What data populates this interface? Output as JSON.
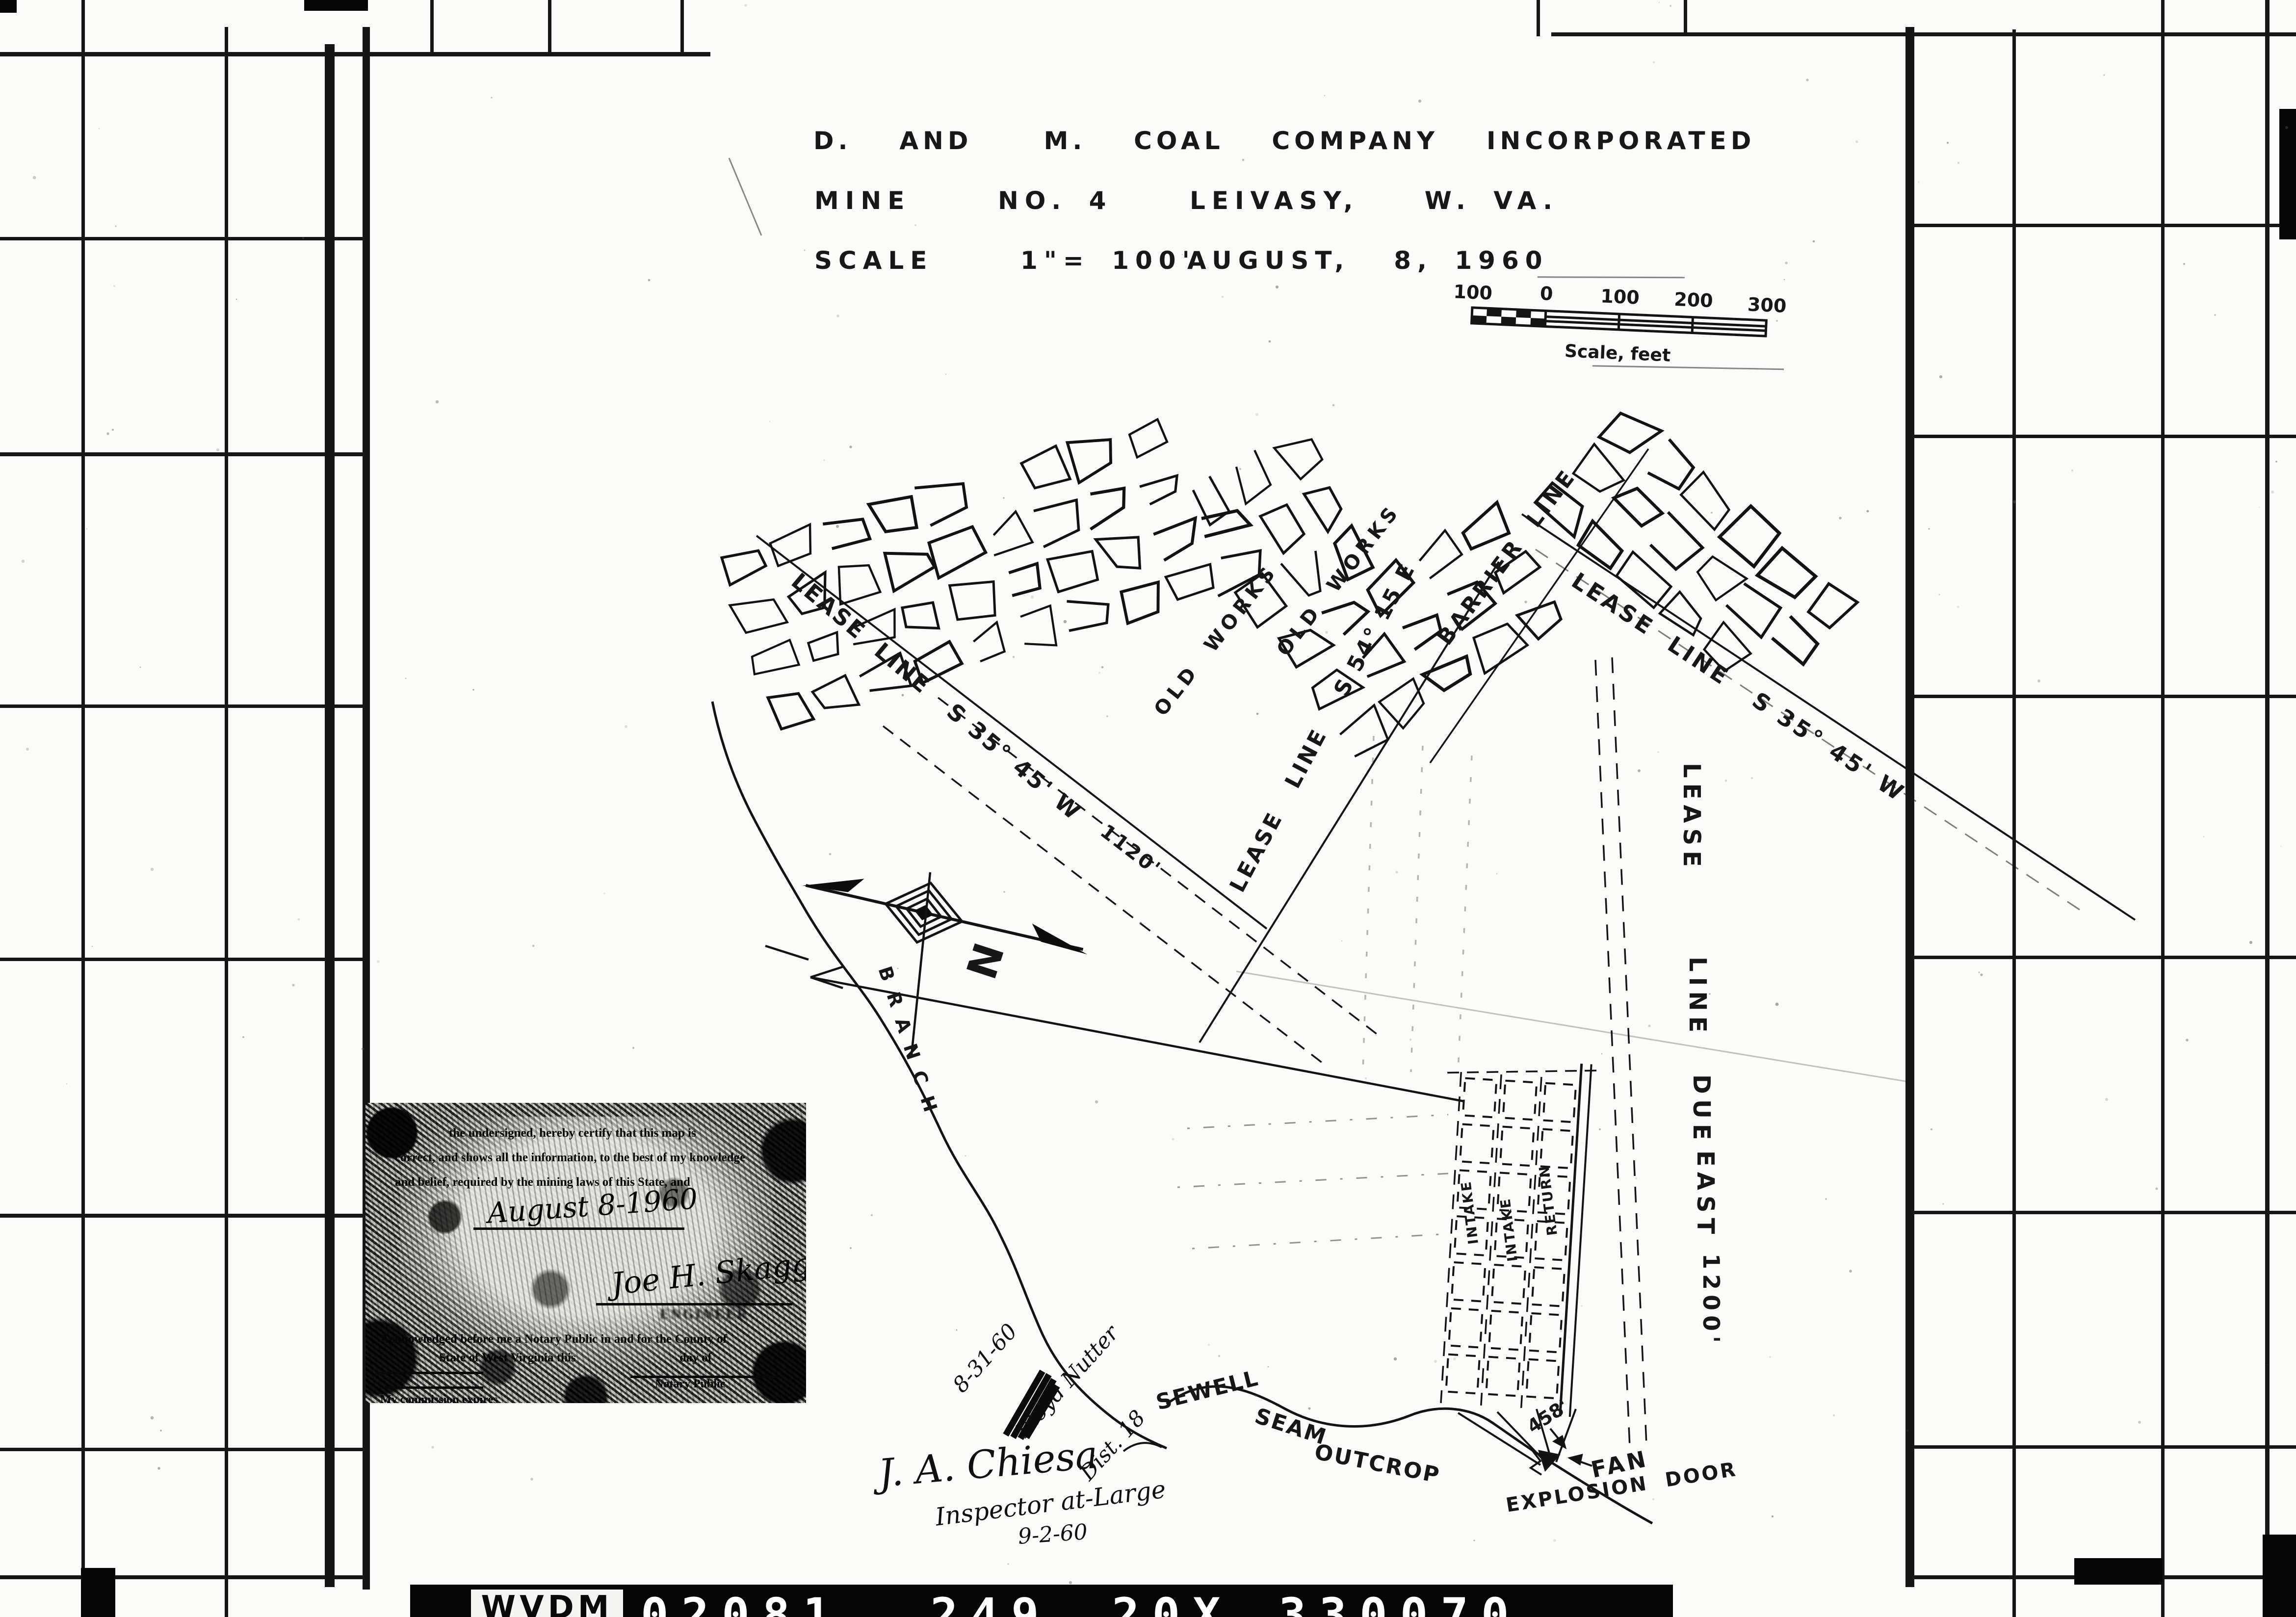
{
  "title_block": {
    "company": "D.  AND   M.  COAL  COMPANY  INCORPORATED",
    "mine": "MINE    NO. 4",
    "location": "LEIVASY,   W. VA.",
    "scale": "SCALE    1\"= 100'",
    "date": "AUGUST,  8, 1960"
  },
  "scale_bar": {
    "ticks": [
      "100",
      "0",
      "100",
      "200",
      "300"
    ],
    "caption": "Scale, feet"
  },
  "compass": {
    "north": "N"
  },
  "map": {
    "lease_line_left": "LEASE  LINE   S 35° 45' W",
    "lease_line_right": "LEASE  LINE   S 35° 45' W",
    "lease_line_se": "LEASE   LINE    S 54° 15 E",
    "barrier": "BARRIER  LINE",
    "old_works_a": "OLD  WORKS",
    "old_works_b": "OLD  WORKS",
    "due_east": {
      "w1": "LEASE",
      "w2": "LINE",
      "w3": "DUE",
      "w4": "EAST",
      "w5": "1200'"
    },
    "dim_1120": "1120'",
    "intake_a": "INTAKE",
    "intake_b": "INTAKE",
    "return_entry": "RETURN",
    "dim_458": "458'",
    "fan": "FAN",
    "explosion_door": "EXPLOSION  DOOR",
    "outcrop": {
      "w1": "SEWELL",
      "w2": "SEAM",
      "w3": "OUTCROP"
    },
    "branch": "BRANCH"
  },
  "certification": {
    "line1": "the undersigned, hereby certify that this map is",
    "line2": "correct, and shows all the information, to the best of my knowledge",
    "line3": "and belief, required by the mining laws of this State, and",
    "date_script": "August 8-1960",
    "signature": "Joe H. Skaggs",
    "signature_caption": "ENGINEER",
    "ack1": "Acknowledged before me a Notary Public in and for the County of",
    "ack2": "State of West Virginia this",
    "ack2b": "day of",
    "notary": "Notary Public",
    "commission": "My commission expires"
  },
  "annotations": {
    "date_a": "8-31-60",
    "name_a": "Floyd Nutter",
    "district": "Dist. 18",
    "signature_b": "J. A. Chiesa",
    "title_b": "Inspector at-Large",
    "date_b": "9-2-60"
  },
  "film_frame": {
    "code_label": "WVDM",
    "code_1": "02081",
    "code_2": "249",
    "code_3": "20X",
    "code_4": "330070"
  }
}
